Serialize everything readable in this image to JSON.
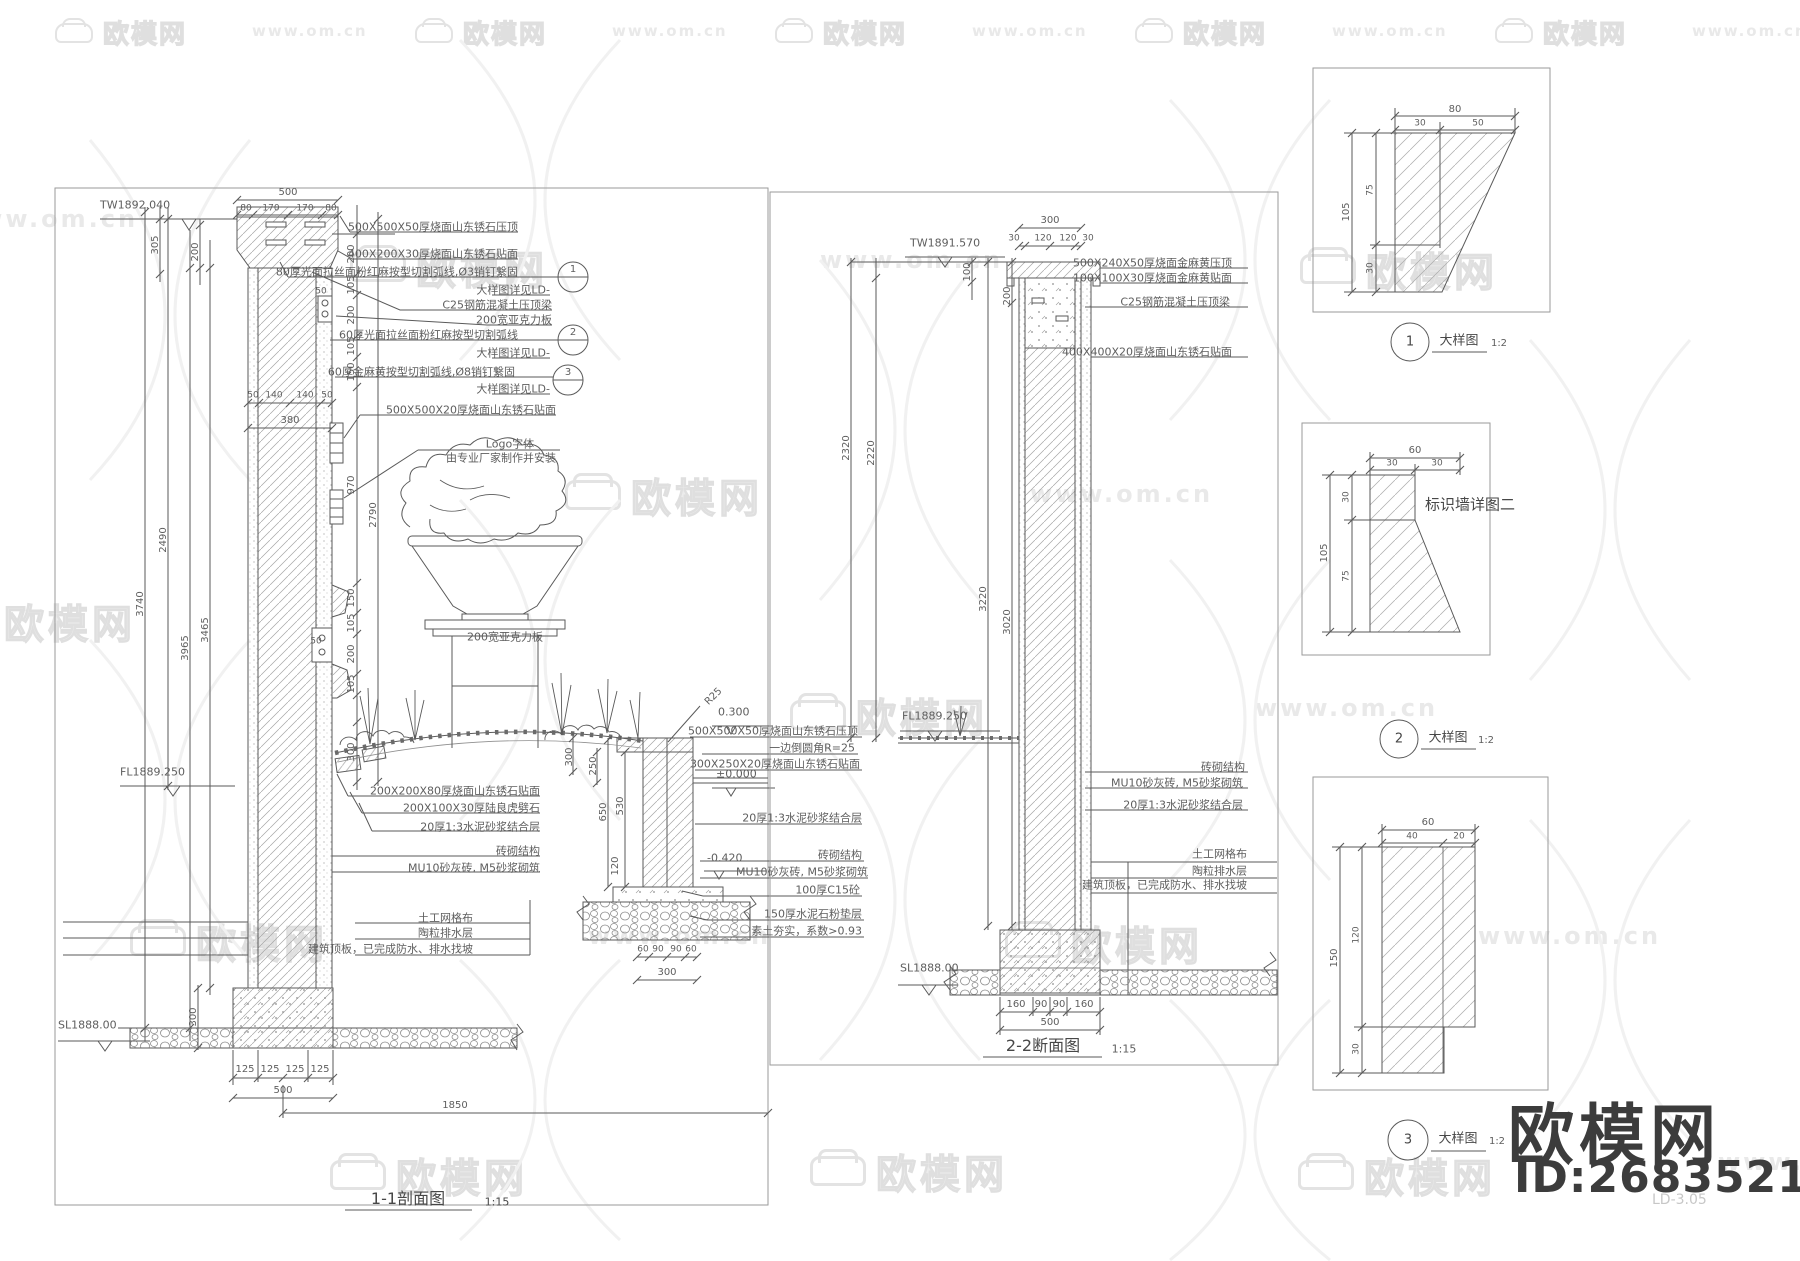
{
  "wm": {
    "brand": "欧模网",
    "url": "www.om.cn"
  },
  "footer": {
    "brand": "欧模网",
    "id": "ID:2683521",
    "sheet": "LD-3.05"
  },
  "side_title": "标识墙详图二",
  "s1": {
    "title": "1-1剖面图",
    "scale": "1:15",
    "lv_top": "TW1892.040",
    "lv_fl": "FL1889.250",
    "lv_sl": "SL1888.00",
    "ann": [
      "500X500X50厚烧面山东锈石压顶",
      "400X200X30厚烧面山东锈石贴面",
      "80厚光面拉丝面粉红麻按型切割弧线,Ø3销钉繋固",
      "大样图详见LD-",
      "C25钢筋混凝土压顶梁",
      "200宽亚克力板",
      "60厚光面拉丝面粉红麻按型切割弧线",
      "大样图详见LD-",
      "60厚金麻黄按型切割弧线,Ø8销钉繋固",
      "大样图详见LD-",
      "500X500X20厚烧面山东锈石贴面",
      "Logo字体",
      "由专业厂家制作并安装",
      "200宽亚克力板"
    ],
    "mid": [
      "200X200X80厚烧面山东锈石贴面",
      "200X100X30厚陆良虎劈石",
      "20厚1:3水泥砂浆结合层",
      "砖砌结构",
      "MU10砂灰砖, M5砂浆砌筑"
    ],
    "deck": [
      "土工网格布",
      "陶粒排水层",
      "建筑顶板，已完成防水、排水找坡"
    ],
    "curb": [
      "500X500X50厚烧面山东锈石压顶",
      "一边倒圆角R=25",
      "300X250X20厚烧面山东锈石贴面",
      "20厚1:3水泥砂浆结合层",
      "砖砌结构",
      "MU10砂灰砖, M5砂浆砌筑",
      "100厚C15砼",
      "150厚水泥石粉垫层",
      "素土夯实，系数>0.93"
    ],
    "marks": {
      "r25": "R25",
      "p300": "0.300",
      "zero": "±0.000",
      "neg": "-0.420"
    },
    "bub": [
      "1",
      "2",
      "3"
    ],
    "dim": {
      "t500": "500",
      "tp": [
        "80",
        "170",
        "170",
        "80"
      ],
      "d305": "305",
      "d200": "200",
      "rc": [
        "200",
        "105",
        "200",
        "105",
        "150"
      ],
      "d970": "970",
      "d2790": "2790",
      "rc2": [
        "150",
        "105",
        "200",
        "105"
      ],
      "d300r": "300",
      "w": [
        "50",
        "140",
        "140",
        "50"
      ],
      "w380": "380",
      "lft": [
        "3740",
        "2490",
        "3965",
        "3465"
      ],
      "d50a": "50",
      "d50b": "50",
      "curbv": [
        "300",
        "250",
        "650",
        "530",
        "120"
      ],
      "g": [
        "60",
        "90",
        "90",
        "60"
      ],
      "g300": "300",
      "f": [
        "125",
        "125",
        "125",
        "125"
      ],
      "f500": "500",
      "f1850": "1850",
      "d300b": "300"
    }
  },
  "s2": {
    "title": "2-2断面图",
    "scale": "1:15",
    "lv_top": "TW1891.570",
    "lv_fl": "FL1889.250",
    "lv_sl": "SL1888.00",
    "ann": [
      "500X240X50厚烧面金麻黄压顶",
      "100X100X30厚烧面金麻黄贴面",
      "C25钢筋混凝土压顶梁",
      "400X400X20厚烧面山东锈石贴面",
      "砖砌结构",
      "MU10砂灰砖, M5砂浆砌筑",
      "20厚1:3水泥砂浆结合层",
      "土工网格布",
      "陶粒排水层",
      "建筑顶板，已完成防水、排水找坡"
    ],
    "dim": {
      "t300": "300",
      "tp": [
        "30",
        "120",
        "120",
        "30"
      ],
      "d100": "100",
      "d200": "200",
      "lft": [
        "2320",
        "2220",
        "3220",
        "3020"
      ],
      "b": [
        "160",
        "90",
        "90",
        "160"
      ],
      "b500": "500"
    }
  },
  "det": [
    {
      "no": "1",
      "name": "大样图",
      "scale": "1:2",
      "t": "80",
      "tp": [
        "30",
        "50"
      ],
      "s": "105",
      "sp": [
        "75",
        "30"
      ]
    },
    {
      "no": "2",
      "name": "大样图",
      "scale": "1:2",
      "t": "60",
      "tp": [
        "30",
        "30"
      ],
      "s": "105",
      "sp": [
        "30",
        "75"
      ]
    },
    {
      "no": "3",
      "name": "大样图",
      "scale": "1:2",
      "t": "60",
      "tp": [
        "40",
        "20"
      ],
      "s": "150",
      "sp": [
        "120",
        "30"
      ]
    }
  ]
}
